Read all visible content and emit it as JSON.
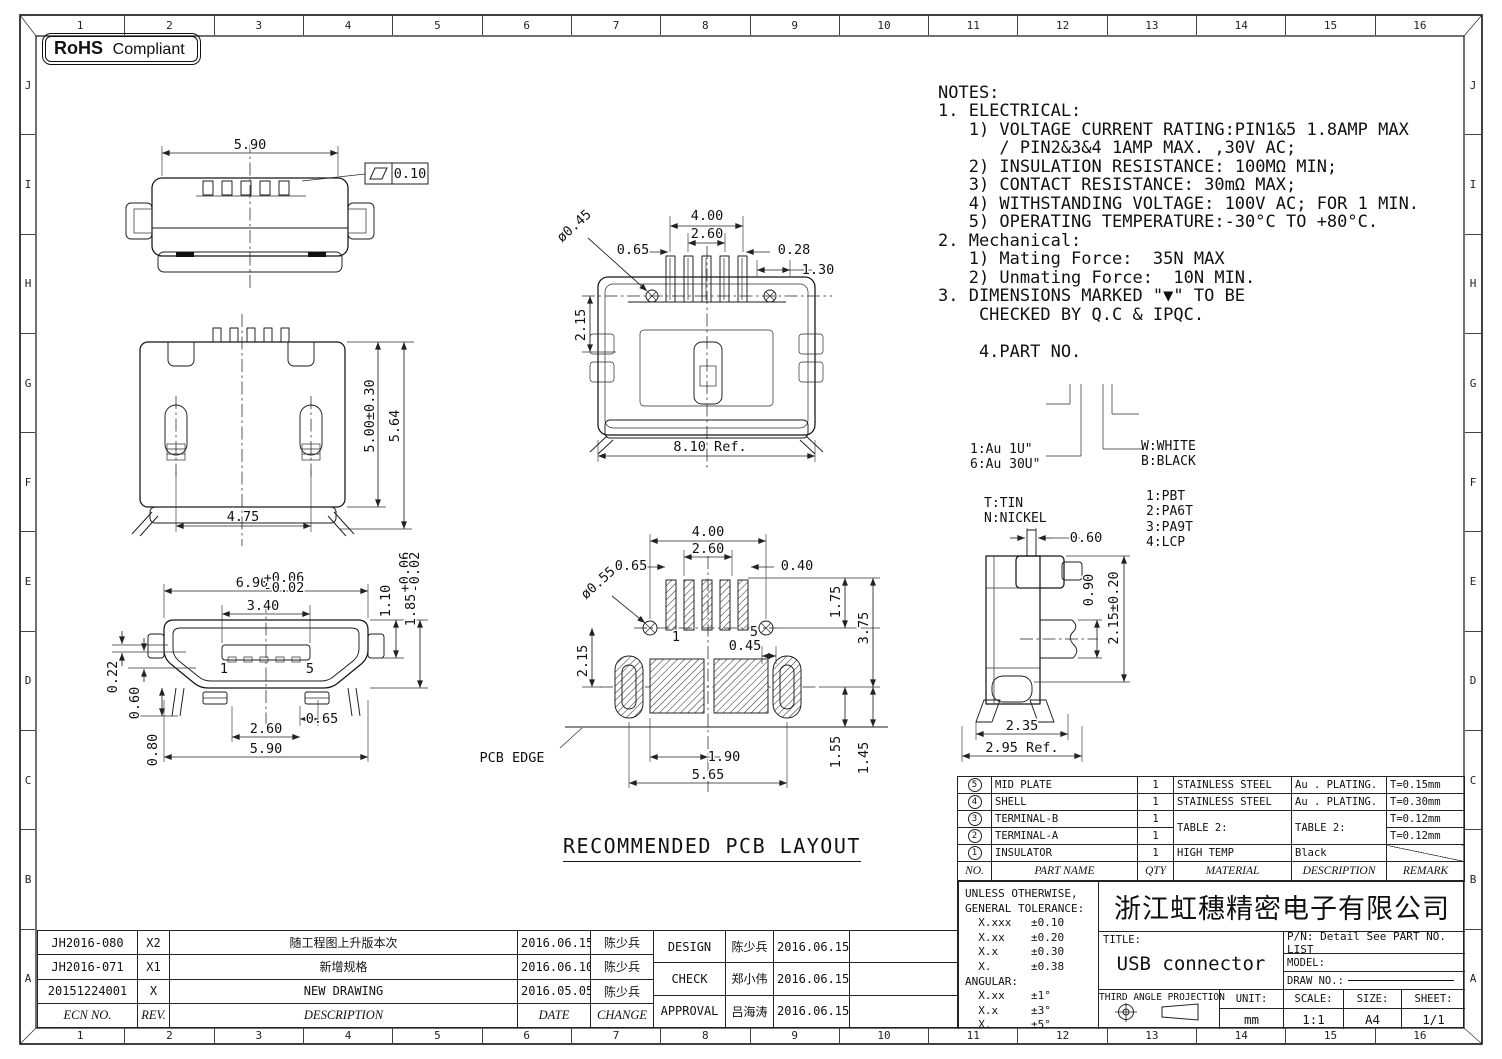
{
  "rohs": {
    "bold": "RoHS",
    "rest": "Compliant"
  },
  "border": {
    "cols": [
      "1",
      "2",
      "3",
      "4",
      "5",
      "6",
      "7",
      "8",
      "9",
      "10",
      "11",
      "12",
      "13",
      "14",
      "15",
      "16"
    ],
    "rows": [
      "J",
      "I",
      "H",
      "G",
      "F",
      "E",
      "D",
      "C",
      "B",
      "A"
    ]
  },
  "notes": {
    "lines": [
      "NOTES:",
      "1. ELECTRICAL:",
      "   1) VOLTAGE CURRENT RATING:PIN1&5 1.8AMP MAX",
      "      / PIN2&3&4 1AMP MAX. ,30V AC;",
      "   2) INSULATION RESISTANCE: 100MΩ MIN;",
      "   3) CONTACT RESISTANCE: 30mΩ MAX;",
      "   4) WITHSTANDING VOLTAGE: 100V AC; FOR 1 MIN.",
      "   5) OPERATING TEMPERATURE:-30°C TO +80°C.",
      "2. Mechanical:",
      "   1) Mating Force:  35N MAX",
      "   2) Unmating Force:  10N MIN.",
      "3. DIMENSIONS MARKED \"▼\" TO BE",
      "    CHECKED BY Q.C & IPQC.",
      " ",
      "    4.PART NO."
    ]
  },
  "legend": {
    "plating": [
      "1:Au 1U\"",
      "6:Au 30U\""
    ],
    "finish": [
      "T:TIN",
      "N:NICKEL"
    ],
    "colors": [
      "W:WHITE",
      "B:BLACK"
    ],
    "materials": [
      "1:PBT",
      "2:PA6T",
      "3:PA9T",
      "4:LCP"
    ]
  },
  "headings": {
    "pcb_layout": "RECOMMENDED PCB LAYOUT"
  },
  "dims": [
    {
      "t": "5.90",
      "x": 250,
      "y": 149
    },
    {
      "t": "0.10",
      "x": 410,
      "y": 178
    },
    {
      "t": "5.00±0.30",
      "x": 374,
      "y": 416,
      "tr": "rotate(-90 374 416)"
    },
    {
      "t": "5.64",
      "x": 399,
      "y": 426,
      "tr": "rotate(-90 399 426)"
    },
    {
      "t": "4.75",
      "x": 243,
      "y": 521
    },
    {
      "t": "6.90",
      "x": 252,
      "y": 587
    },
    {
      "t": "+0.06",
      "x": 284,
      "y": 582,
      "fs": "9.5"
    },
    {
      "t": "-0.02",
      "x": 284,
      "y": 592,
      "fs": "9.5"
    },
    {
      "t": "3.40",
      "x": 263,
      "y": 610
    },
    {
      "t": "1.10",
      "x": 390,
      "y": 601,
      "tr": "rotate(-90 390 601)"
    },
    {
      "t": "+0.06",
      "x": 409,
      "y": 572,
      "tr": "rotate(-90 409 572)",
      "fs": "9.5"
    },
    {
      "t": "-0.02",
      "x": 419,
      "y": 572,
      "tr": "rotate(-90 419 572)",
      "fs": "9.5"
    },
    {
      "t": "1.85",
      "x": 415,
      "y": 610,
      "tr": "rotate(-90 415 610)"
    },
    {
      "t": "0.22",
      "x": 117,
      "y": 677,
      "tr": "rotate(-90 117 677)"
    },
    {
      "t": "0.60",
      "x": 139,
      "y": 703,
      "tr": "rotate(-90 139 703)"
    },
    {
      "t": "0.80",
      "x": 157,
      "y": 750,
      "tr": "rotate(-90 157 750)"
    },
    {
      "t": "0.65",
      "x": 322,
      "y": 723,
      "ta": "start"
    },
    {
      "t": "2.60",
      "x": 266,
      "y": 733
    },
    {
      "t": "5.90",
      "x": 266,
      "y": 753
    },
    {
      "t": "1",
      "x": 224,
      "y": 673,
      "fs": "12"
    },
    {
      "t": "5",
      "x": 310,
      "y": 673,
      "fs": "12"
    },
    {
      "t": "4.00",
      "x": 707,
      "y": 220
    },
    {
      "t": "2.60",
      "x": 707,
      "y": 238
    },
    {
      "t": "0.65",
      "x": 633,
      "y": 254
    },
    {
      "t": "0.28",
      "x": 794,
      "y": 254
    },
    {
      "t": "1.30",
      "x": 818,
      "y": 274,
      "ta": "start"
    },
    {
      "t": "ø0.45",
      "x": 577,
      "y": 229,
      "tr": "rotate(-42 577 229)"
    },
    {
      "t": "2.15",
      "x": 585,
      "y": 325,
      "tr": "rotate(-90 585 325)"
    },
    {
      "t": "8.10 Ref.",
      "x": 710,
      "y": 451
    },
    {
      "t": "4.00",
      "x": 708,
      "y": 536
    },
    {
      "t": "2.60",
      "x": 708,
      "y": 553
    },
    {
      "t": "0.65",
      "x": 631,
      "y": 570
    },
    {
      "t": "0.40",
      "x": 797,
      "y": 570
    },
    {
      "t": "ø0.55",
      "x": 601,
      "y": 586,
      "tr": "rotate(-42 601 586)"
    },
    {
      "t": "1.75",
      "x": 840,
      "y": 602,
      "tr": "rotate(-90 840 602)"
    },
    {
      "t": "3.75",
      "x": 868,
      "y": 628,
      "tr": "rotate(-90 868 628)"
    },
    {
      "t": "2.15",
      "x": 587,
      "y": 661,
      "tr": "rotate(-90 587 661)"
    },
    {
      "t": "0.45",
      "x": 745,
      "y": 650
    },
    {
      "t": "1.90",
      "x": 724,
      "y": 761,
      "ta": "start"
    },
    {
      "t": "5.65",
      "x": 708,
      "y": 779
    },
    {
      "t": "1.55",
      "x": 840,
      "y": 752,
      "tr": "rotate(-90 840 752)"
    },
    {
      "t": "1.45",
      "x": 868,
      "y": 758,
      "tr": "rotate(-90 868 758)"
    },
    {
      "t": "1",
      "x": 676,
      "y": 641,
      "fs": "12"
    },
    {
      "t": "5",
      "x": 754,
      "y": 636,
      "fs": "12"
    },
    {
      "t": "PCB EDGE",
      "x": 512,
      "y": 762,
      "fs": "15"
    },
    {
      "t": "0.60",
      "x": 1086,
      "y": 542,
      "ta": "start"
    },
    {
      "t": "0.90",
      "x": 1093,
      "y": 590,
      "tr": "rotate(-90 1093 590)"
    },
    {
      "t": "2.15±0.20",
      "x": 1118,
      "y": 608,
      "tr": "rotate(-90 1118 608)"
    },
    {
      "t": "2.35",
      "x": 1022,
      "y": 730
    },
    {
      "t": "2.95 Ref.",
      "x": 1022,
      "y": 752
    }
  ],
  "parts": {
    "headers": {
      "no": "NO.",
      "name": "PART NAME",
      "qty": "QTY",
      "material": "MATERIAL",
      "description": "DESCRIPTION",
      "remark": "REMARK"
    },
    "merged": {
      "material": "TABLE 2:",
      "description": "TABLE 2:"
    },
    "rows": [
      {
        "no": "5",
        "name": "MID PLATE",
        "qty": "1",
        "material": "STAINLESS STEEL",
        "description": "Au . PLATING.",
        "remark": "T=0.15mm"
      },
      {
        "no": "4",
        "name": "SHELL",
        "qty": "1",
        "material": "STAINLESS STEEL",
        "description": "Au . PLATING.",
        "remark": "T=0.30mm"
      },
      {
        "no": "3",
        "name": "TERMINAL-B",
        "qty": "1",
        "remark": "T=0.12mm"
      },
      {
        "no": "2",
        "name": "TERMINAL-A",
        "qty": "1",
        "remark": "T=0.12mm"
      },
      {
        "no": "1",
        "name": "INSULATOR",
        "qty": "1",
        "material": "HIGH TEMP",
        "description": "Black",
        "remark": ""
      }
    ]
  },
  "tolerance": {
    "lines": [
      {
        "l": "UNLESS OTHERWISE,"
      },
      {
        "l": "GENERAL TOLERANCE:"
      },
      {
        "l": "  X.xxx",
        "v": "±0.10"
      },
      {
        "l": "  X.xx",
        "v": "±0.20"
      },
      {
        "l": "  X.x",
        "v": "±0.30"
      },
      {
        "l": "  X.",
        "v": "±0.38"
      },
      {
        "l": "ANGULAR:"
      },
      {
        "l": "  X.xx",
        "v": "±1°"
      },
      {
        "l": "  X.x",
        "v": "±3°"
      },
      {
        "l": "  X.",
        "v": "±5°"
      }
    ]
  },
  "title_block": {
    "company": "浙江虹穗精密电子有限公司",
    "title_label": "TITLE:",
    "title": "USB connector",
    "pn": "P/N: Detail See PART NO. LIST",
    "model_label": "MODEL:",
    "draw_label": "DRAW NO.:",
    "projection_label": "THIRD ANGLE PROJECTION",
    "unit_label": "UNIT:",
    "unit_value": "mm",
    "scale_label": "SCALE:",
    "scale_value": "1:1",
    "size_label": "SIZE:",
    "size_value": "A4",
    "sheet_label": "SHEET:",
    "sheet_value": "1/1"
  },
  "revision": {
    "rows": [
      [
        "JH2016-080",
        "X2",
        "随工程图上升版本次",
        "2016.06.15",
        "陈少兵"
      ],
      [
        "JH2016-071",
        "X1",
        "新增规格",
        "2016.06.10",
        "陈少兵"
      ],
      [
        "20151224001",
        "X",
        "NEW DRAWING",
        "2016.05.05",
        "陈少兵"
      ],
      [
        "ECN NO.",
        "REV.",
        "DESCRIPTION",
        "DATE",
        "CHANGE"
      ]
    ]
  },
  "approval": {
    "rows": [
      [
        "DESIGN",
        "陈少兵",
        "2016.06.15",
        ""
      ],
      [
        "CHECK",
        "郑小伟",
        "2016.06.15",
        ""
      ],
      [
        "APPROVAL",
        "吕海涛",
        "2016.06.15",
        ""
      ]
    ]
  }
}
